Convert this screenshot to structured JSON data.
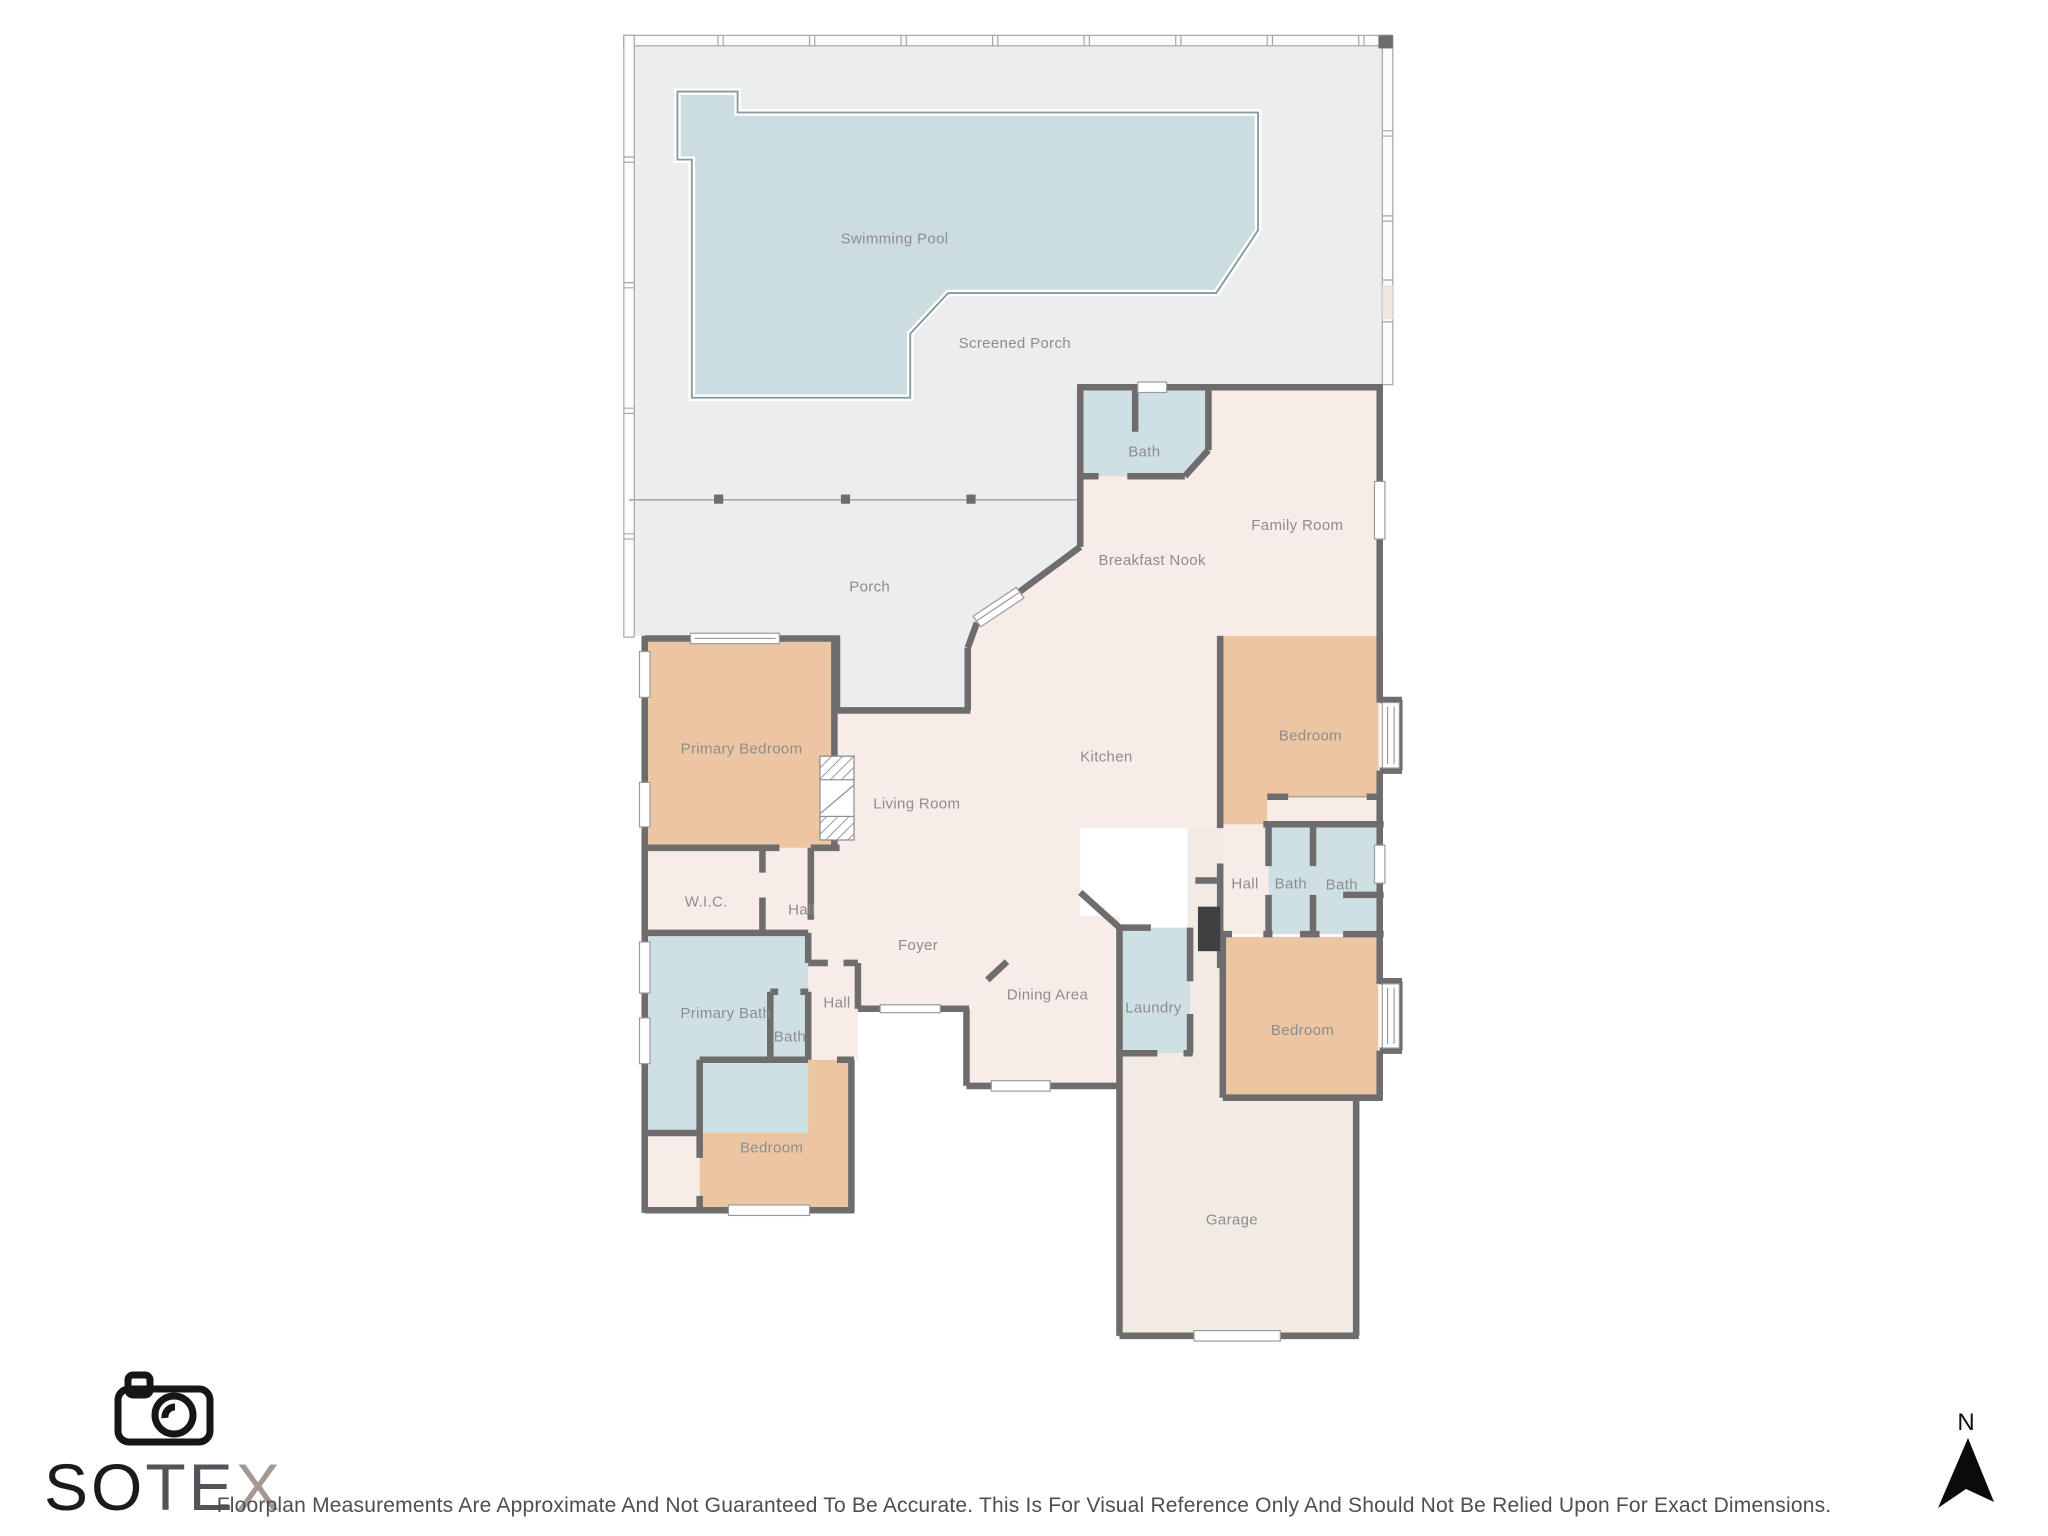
{
  "rooms": [
    {
      "id": "swimming_pool",
      "label": "Swimming Pool"
    },
    {
      "id": "screened_porch",
      "label": "Screened Porch"
    },
    {
      "id": "porch",
      "label": "Porch"
    },
    {
      "id": "bath_top",
      "label": "Bath"
    },
    {
      "id": "family_room",
      "label": "Family Room"
    },
    {
      "id": "breakfast_nook",
      "label": "Breakfast Nook"
    },
    {
      "id": "kitchen",
      "label": "Kitchen"
    },
    {
      "id": "bedroom_ne",
      "label": "Bedroom"
    },
    {
      "id": "living_room",
      "label": "Living Room"
    },
    {
      "id": "primary_bedroom",
      "label": "Primary Bedroom"
    },
    {
      "id": "wic",
      "label": "W.I.C."
    },
    {
      "id": "hall_upper",
      "label": "Hall"
    },
    {
      "id": "foyer",
      "label": "Foyer"
    },
    {
      "id": "hall_right",
      "label": "Hall"
    },
    {
      "id": "bath_right1",
      "label": "Bath"
    },
    {
      "id": "bath_right2",
      "label": "Bath"
    },
    {
      "id": "dining_area",
      "label": "Dining Area"
    },
    {
      "id": "laundry",
      "label": "Laundry"
    },
    {
      "id": "hall_lower",
      "label": "Hall"
    },
    {
      "id": "primary_bath",
      "label": "Primary Bath"
    },
    {
      "id": "bath_lower",
      "label": "Bath"
    },
    {
      "id": "bedroom_se",
      "label": "Bedroom"
    },
    {
      "id": "bedroom_sw",
      "label": "Bedroom"
    },
    {
      "id": "garage",
      "label": "Garage"
    }
  ],
  "branding": {
    "name": "SOTEX",
    "icon": "camera-icon",
    "segments": [
      {
        "text": "SO",
        "color": "#1c1b1a"
      },
      {
        "text": "TE",
        "color": "#57525a"
      },
      {
        "text": "X",
        "color": "#a59792"
      }
    ]
  },
  "compass": {
    "label": "N"
  },
  "footer": {
    "disclaimer": "Floorplan Measurements Are Approximate And Not Guaranteed To Be Accurate. This Is For Visual Reference Only And Should Not Be Relied Upon For Exact Dimensions."
  },
  "colors": {
    "wall": "#6e6c6d",
    "room": "#f7ece7",
    "bedroom": "#ecc6a3",
    "bath": "#cfe0e4",
    "porch": "#ebedee",
    "pool": "#ccdde0",
    "pool_edge": "#87999b",
    "garage": "#f1ebe4",
    "label": "#8e8d8d",
    "screen": "#a5a5a5",
    "fixture_dark": "#3f3e40"
  }
}
